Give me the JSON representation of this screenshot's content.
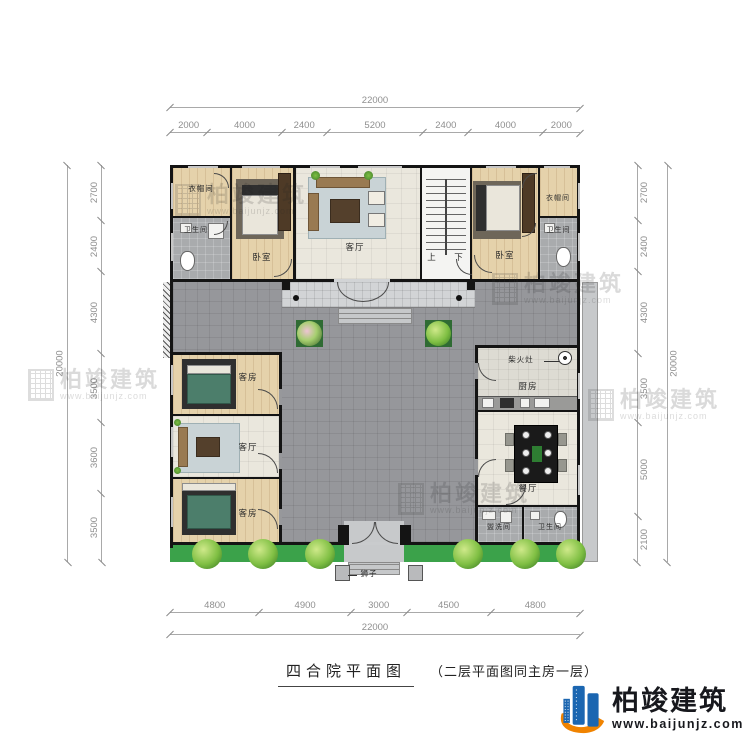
{
  "title": {
    "main": "四合院平面图",
    "note": "（二层平面图同主房一层）"
  },
  "logo": {
    "name": "柏竣建筑",
    "url": "www.baijunjz.com"
  },
  "watermark": {
    "name": "柏竣建筑",
    "url": "www.baijunjz.com"
  },
  "dimensions": {
    "top": {
      "total": "22000",
      "segments": [
        2000,
        4000,
        2400,
        5200,
        2400,
        4000,
        2000
      ]
    },
    "bottom": {
      "total": "22000",
      "segments": [
        4800,
        4900,
        3000,
        4500,
        4800
      ]
    },
    "left": {
      "total": "20000",
      "segments": [
        2700,
        2400,
        4300,
        3500,
        3600,
        3500
      ]
    },
    "right": {
      "total": "20000",
      "segments": [
        2700,
        2400,
        4300,
        3500,
        5000,
        2100
      ]
    }
  },
  "rooms": {
    "nw_closet": "衣帽间",
    "nw_bath": "卫生间",
    "nw_bedroom": "卧室",
    "main_hall": "客厅",
    "stairs_up": "上",
    "stairs_down": "下",
    "ne_bedroom": "卧室",
    "ne_closet": "衣帽间",
    "ne_bath": "卫生间",
    "west_guest_top": "客房",
    "west_hall": "客厅",
    "west_guest_bottom": "客房",
    "stove": "柴火灶",
    "kitchen": "厨房",
    "dining": "餐厅",
    "washroom": "盥洗间",
    "se_bath": "卫生间",
    "lions": "狮子"
  },
  "colors": {
    "wall": "#141414",
    "wood_floor": "#e5d2ab",
    "tile_floor": "#eae7dd",
    "bath_floor": "#a9abad",
    "courtyard": "#96979b",
    "veranda": "#d2d4d6",
    "lawn": "#3ba24a",
    "logo_blue": "#1b66b1",
    "logo_orange": "#f08300"
  }
}
